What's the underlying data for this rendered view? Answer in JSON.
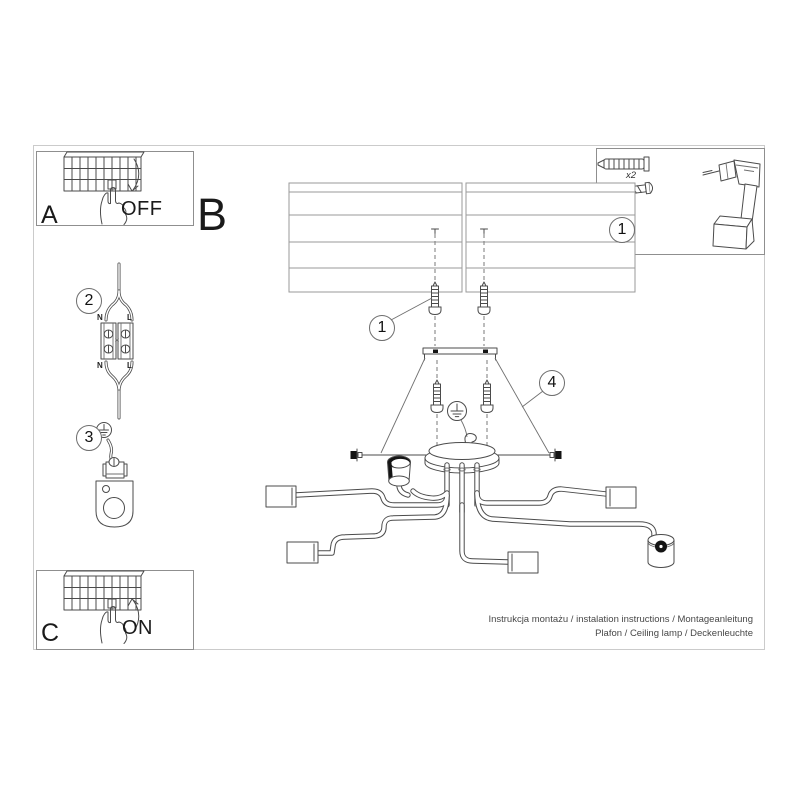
{
  "colors": {
    "line": "#4b4b4b",
    "light_line": "#9a9a9a",
    "sheet_frame": "#cbcbcb",
    "box_border": "#8f8f8f",
    "black_fill": "#141414",
    "background": "#ffffff"
  },
  "labels": {
    "step_a": {
      "letter": "A",
      "state": "OFF"
    },
    "step_b": {
      "letter": "B"
    },
    "step_c": {
      "letter": "C",
      "state": "ON"
    },
    "callout_tools": "1",
    "callout_screws": "1",
    "callout_connector": "2",
    "callout_ground": "3",
    "callout_canopy": "4",
    "anchor_quantity": "x2"
  },
  "wiring_labels": {
    "top_neutral": "N",
    "top_line": "L",
    "bottom_neutral": "N",
    "bottom_line": "L"
  },
  "footer": {
    "line1": "Instrukcja montażu / instalation instructions / Montageanleitung",
    "line2": "Plafon / Ceiling lamp / Deckenleuchte"
  },
  "icons": {
    "breaker_panel": "circuit-breaker-icon",
    "hand": "hand-press-icon",
    "arrow_down": "arrow-down-icon",
    "arrow_up": "arrow-up-icon",
    "wall_plug": "wall-plug-icon",
    "screw": "screw-icon",
    "drill": "drill-icon",
    "terminal_block": "terminal-block-icon",
    "earth_ground": "earth-ground-icon",
    "ground_clamp": "ground-clamp-icon",
    "ceiling": "ceiling-panels-icon",
    "bracket": "mounting-bracket-icon",
    "canopy": "canopy-icon",
    "lamp": "lamp-arms-icon",
    "socket_cup": "socket-cup-icon"
  }
}
